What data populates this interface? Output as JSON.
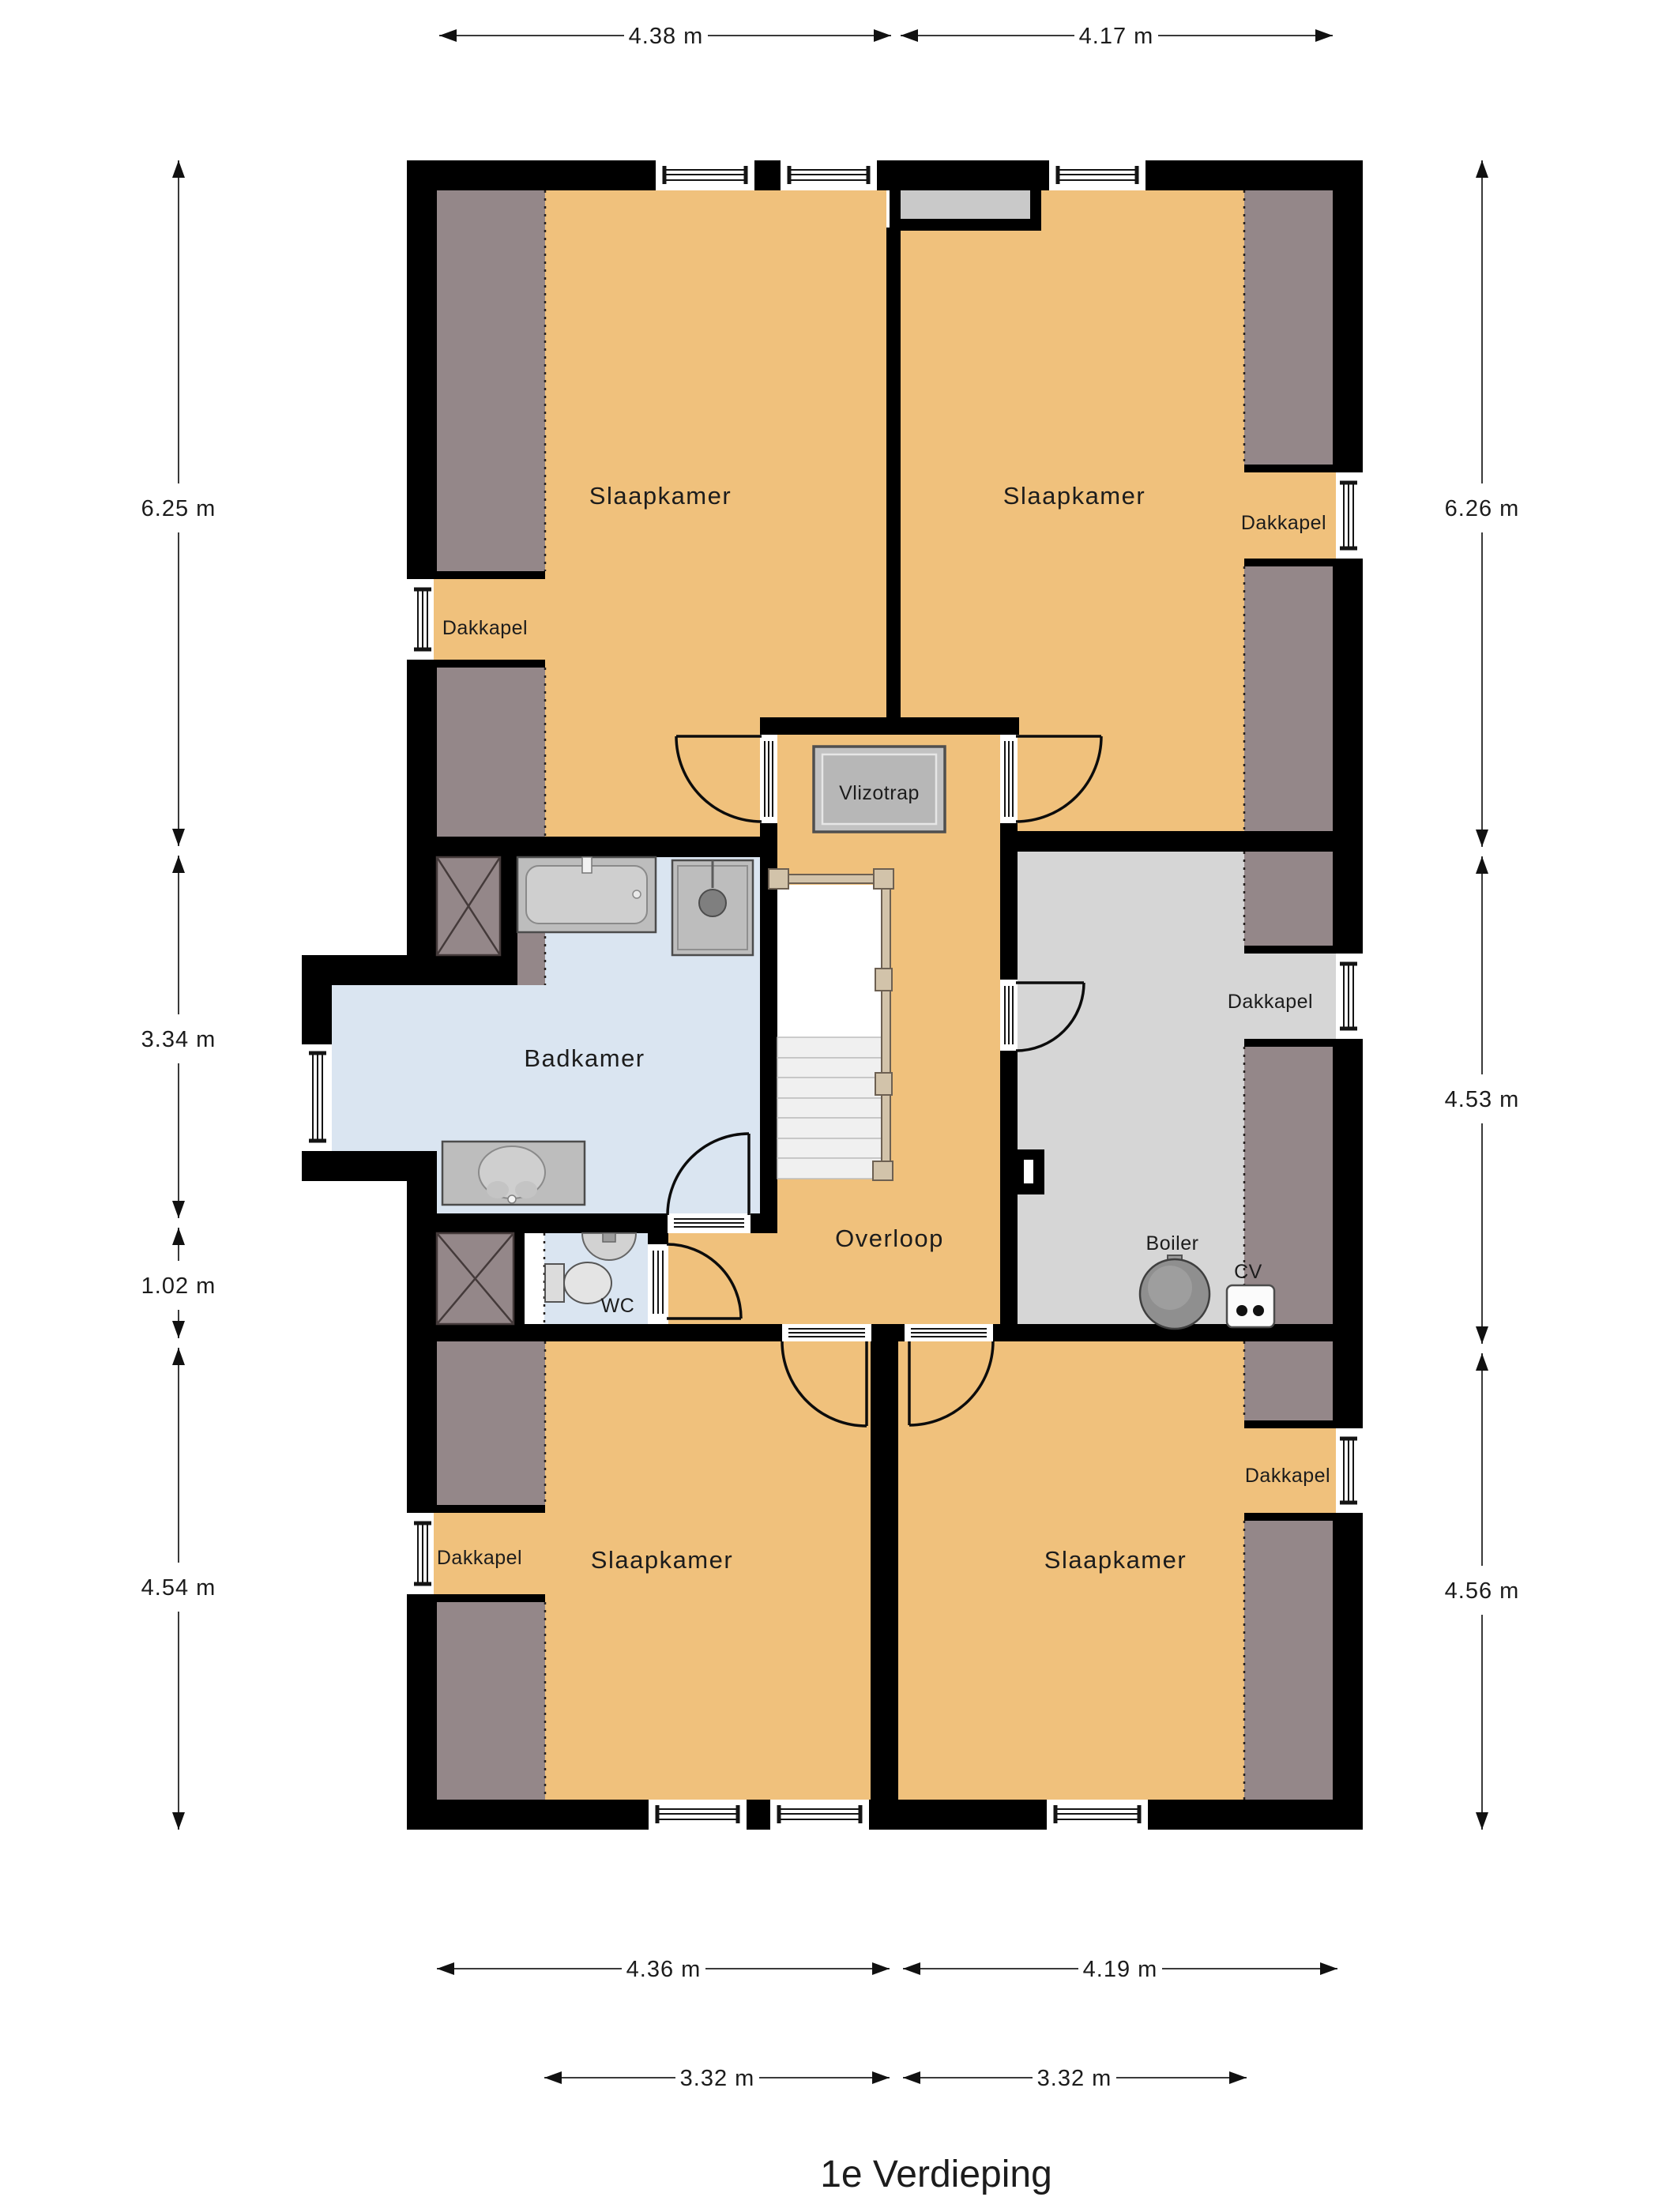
{
  "title": "1e Verdieping",
  "labels": {
    "bedroom": "Slaapkamer",
    "bathroom": "Badkamer",
    "toilet": "WC",
    "landing": "Overloop",
    "loft_hatch": "Vlizotrap",
    "dormer": "Dakkapel",
    "boiler": "Boiler",
    "central_heating": "CV"
  },
  "dimensions": {
    "top": [
      "4.38 m",
      "4.17 m"
    ],
    "left": [
      "6.25 m",
      "3.34 m",
      "1.02 m",
      "4.54 m"
    ],
    "right": [
      "6.26 m",
      "4.53 m",
      "4.56 m"
    ],
    "bottom": [
      "4.36 m",
      "4.19 m"
    ],
    "bottom_inner": [
      "3.32 m",
      "3.32 m"
    ]
  },
  "colors": {
    "wall": "#000000",
    "floor": "#f0c17c",
    "slope": "#948789",
    "bathroom_floor": "#dae5f1",
    "storage_floor": "#d6d6d6",
    "stair_tread": "#f0f0f0",
    "railing": "#d2c3aa"
  }
}
